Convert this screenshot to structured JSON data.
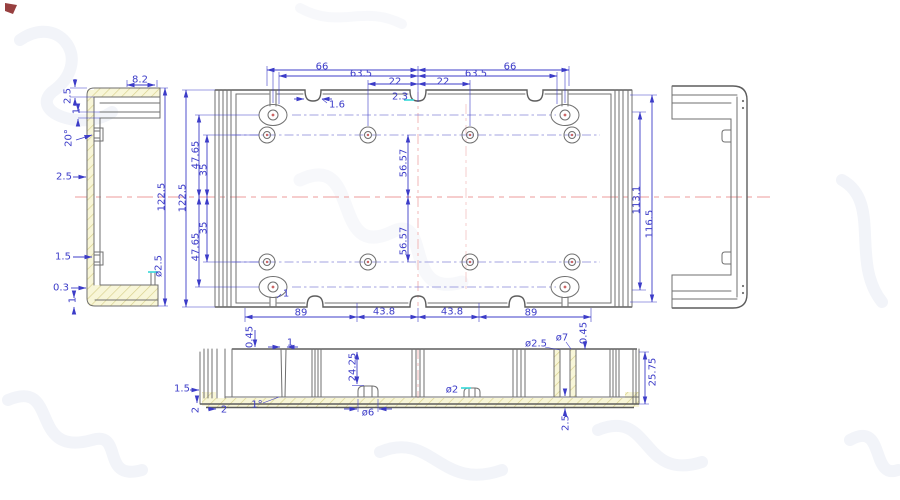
{
  "title": "enclosure-cad-drawing",
  "colors": {
    "dimension": "#3c3cc8",
    "outline": "#6f6f6f",
    "centerline": "#ec9b9b",
    "hatch_fill": "#f8f6d8",
    "hatch_line": "#d8d08a",
    "highlight": "#35d9d9",
    "watermark": "#8fa0c8"
  },
  "views": {
    "side_section": {
      "dims": {
        "w82": "8.2",
        "t25": "2.5",
        "t1": "1",
        "a20": "20°",
        "m25": "2.5",
        "h1225": "122.5",
        "b15": "1.5",
        "b03": "0.3",
        "b1": "1",
        "dia25": "ø2.5"
      }
    },
    "front": {
      "dims": {
        "t66l": "66",
        "t635l": "63.5",
        "t22l": "22",
        "n16": "1.6",
        "n23": "2.3",
        "t22r": "22",
        "t635r": "63.5",
        "t66r": "66",
        "l1225": "122.5",
        "l4765t": "47.65",
        "l35t": "35",
        "l35b": "35",
        "l4765b": "47.65",
        "m5657t": "56.57",
        "m5657b": "56.57",
        "r1131": "113.1",
        "r1165": "116.5",
        "b89l": "89",
        "b438l": "43.8",
        "b438r": "43.8",
        "b89r": "89",
        "slot1": "1"
      }
    },
    "bottom_section": {
      "dims": {
        "t045": "0.45",
        "t1": "1",
        "h2425": "24.25",
        "dia6": "ø6",
        "dia2": "ø2",
        "dia25": "ø2.5",
        "dia7": "ø7",
        "r045": "0.45",
        "r2575": "25.75",
        "f25": "2.5",
        "l15": "1.5",
        "l2a": "2",
        "l2b": "2",
        "a1": "1°"
      }
    }
  }
}
